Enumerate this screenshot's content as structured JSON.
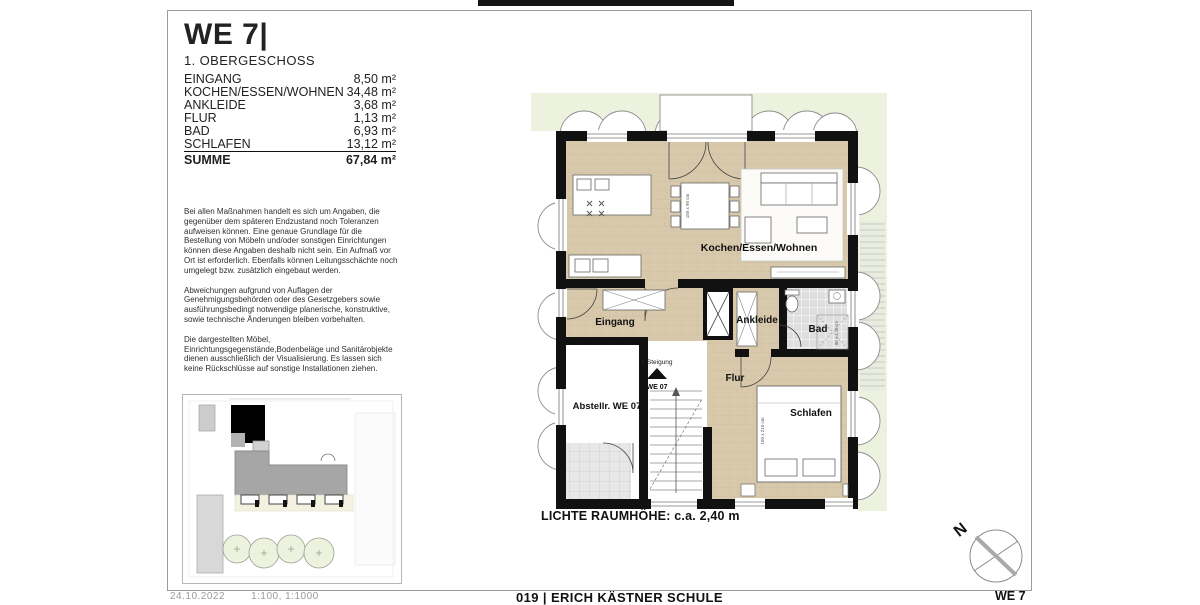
{
  "header": {
    "title": "WE 7|",
    "subtitle": "1. OBERGESCHOSS"
  },
  "room_table": {
    "rows": [
      {
        "label": "EINGANG",
        "value": "8,50 m²"
      },
      {
        "label": "KOCHEN/ESSEN/WOHNEN",
        "value": "34,48 m²"
      },
      {
        "label": "ANKLEIDE",
        "value": "3,68 m²"
      },
      {
        "label": "FLUR",
        "value": "1,13 m²"
      },
      {
        "label": "BAD",
        "value": "6,93 m²"
      },
      {
        "label": "SCHLAFEN",
        "value": "13,12 m²"
      }
    ],
    "total": {
      "label": "SUMME",
      "value": "67,84 m²"
    }
  },
  "disclaimer": {
    "p1": "Bei allen Maßnahmen handelt es sich um Angaben, die gegenüber dem späteren Endzustand noch Toleranzen aufweisen können. Eine genaue Grundlage für die Bestellung von Möbeln und/oder sonstigen Einrichtungen können diese Angaben deshalb nicht sein. Ein Aufmaß vor Ort ist erforderlich. Ebenfalls können Leitungsschächte noch umgelegt bzw. zusätzlich eingebaut werden.",
    "p2": "Abweichungen aufgrund von Auflagen der Genehmigungsbehörden oder des Gesetzgebers sowie ausführungsbedingt notwendige planerische, konstruktive, sowie technische Änderungen bleiben vorbehalten.",
    "p3": "Die dargestellten Möbel,\nEinrichtungsgegenstände,Bodenbeläge und Sanitärobjekte dienen ausschließlich der Visualisierung. Es lassen sich keine Rückschlüsse auf sonstige Installationen ziehen."
  },
  "floorplan": {
    "labels": {
      "kitchen": "Kochen/Essen/Wohnen",
      "entry": "Eingang",
      "dressing": "Ankleide",
      "bath": "Bad",
      "hall": "Flur",
      "sleep": "Schlafen",
      "storage": "Abstellr. WE 07",
      "stair_note": "1 Steigung",
      "stair_unit": "WE 07",
      "table_dim": "150 x 90 cm",
      "bed_dim": "160 x 210 cm",
      "shower_dim": "90 x 1,20 cm"
    },
    "ceiling_note": "LICHTE RAUMHÖHE: c.a. 2,40 m"
  },
  "compass": {
    "north_label": "N"
  },
  "footer": {
    "left_a": "24.10.2022",
    "left_b": "1:100, 1:1000",
    "center": "019 | ERICH KÄSTNER SCHULE",
    "right": "WE 7"
  },
  "colors": {
    "wall": "#111111",
    "wood_floor": "#d9c9ac",
    "bath_tile": "#dedede",
    "garden_green": "#edf2df",
    "building_gray": "#a6a6a6"
  }
}
